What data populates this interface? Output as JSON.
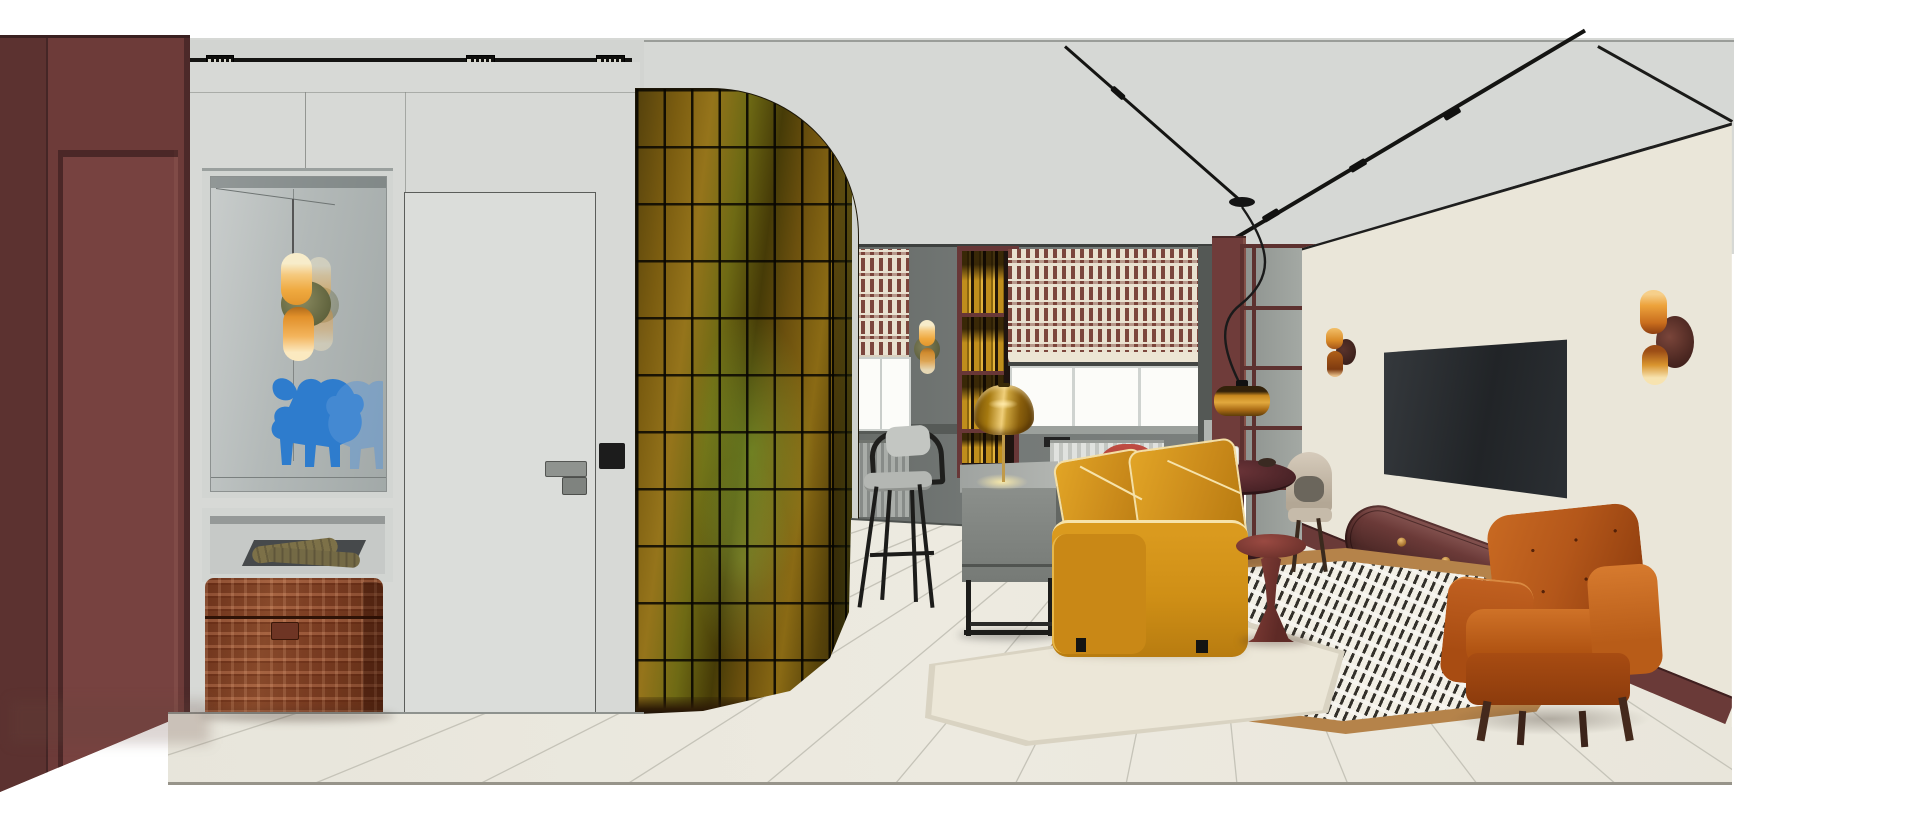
{
  "image": {
    "kind": "interior-design-3d-rendering",
    "style": "mid-century modern apartment, open plan hallway / kitchen / living room",
    "canvas": {
      "width": 1920,
      "height": 814
    },
    "content_bounds": {
      "left": 0,
      "top": 29,
      "right": 1734,
      "bottom": 786
    }
  },
  "palette": {
    "white_margin": "#ffffff",
    "ceiling_grey": "#d6d8d5",
    "wall_light_grey": "#d7d9d6",
    "wall_mid_grey": "#747876",
    "wall_dark_grey": "#565a57",
    "maroon_wall": "#6d3b39",
    "maroon_panel": "#774240",
    "track_black": "#141412",
    "door_white": "#dbddda",
    "glass_tile_amber": "#8a6a14",
    "glass_tile_olive": "#6e6a14",
    "glass_grout": "#0a0801",
    "shade_cream": "#e9e1d0",
    "shade_maroon": "#763e35",
    "sofa_mustard": "#d2901a",
    "sofa_piping_cream": "#f6e3ab",
    "armchair_rust": "#b4571a",
    "chest_cognac": "#8a4426",
    "bull_blue": "#2e7ccd",
    "sconce_amber": "#efa93f",
    "sconce_disc_olive": "#6b6a46",
    "pendant_amber": "#c8881e",
    "dining_table_oxblood": "#4a2327",
    "martini_table_oxblood": "#71342e",
    "console_burgundy": "#5f3331",
    "knob_brass": "#c9963e",
    "wallpaper_cream": "#eae6d9",
    "wallpaper_olive": "#8d8f7e",
    "tv_screen": "#26292c",
    "floor_cream": "#e9e7de",
    "floor_line": "#c5c3b8",
    "rug_cream": "#ece7d8",
    "rug_tan_border": "#b5834a",
    "rug_dash_dark": "#33302a",
    "chair_red": "#c04c42",
    "chair_cream": "#d6cbbb"
  },
  "zones": [
    {
      "name": "entry-hall",
      "objects": [
        "maroon-wall-panels",
        "mirror-niche",
        "double-cylinder-sconce",
        "blue-bull-figurine",
        "gloves-shelf",
        "woven-leather-chest",
        "flush-white-door",
        "door-handle",
        "light-switch"
      ]
    },
    {
      "name": "partition",
      "objects": [
        "curved-amber-glass-block-wall"
      ]
    },
    {
      "name": "kitchen",
      "objects": [
        "roman-shade-left",
        "roman-shade-right",
        "window-left",
        "window-right",
        "radiator-left",
        "radiator-right",
        "kitchen-sconce",
        "bottle-shelf-column",
        "counter-chair",
        "grey-desk",
        "amber-glass-table-lamp"
      ]
    },
    {
      "name": "dining",
      "objects": [
        "round-oxblood-table",
        "red-barrel-chair",
        "cream-barrel-chair-back",
        "cream-barrel-chair-right",
        "glass-cup",
        "dark-bowl"
      ]
    },
    {
      "name": "living",
      "objects": [
        "mustard-velvet-sofa",
        "martini-side-table",
        "burnt-orange-armchair",
        "cream-rug",
        "dashed-pattern-rug",
        "tv",
        "geometric-wallpaper-wall",
        "burgundy-open-shelving",
        "floating-burgundy-console",
        "amber-wall-sconce-left",
        "amber-wall-sconce-right",
        "amber-drum-pendant"
      ]
    },
    {
      "name": "ceiling",
      "objects": [
        "linear-spot-track",
        "recessed-spot-fixtures",
        "diagonal-track-lights",
        "pendant-ceiling-disc"
      ]
    }
  ],
  "lighting_fixtures_count": {
    "recessed_spots": 4,
    "track_studs": 4,
    "sconces": 4,
    "pendants": 1,
    "table_lamps": 1
  }
}
